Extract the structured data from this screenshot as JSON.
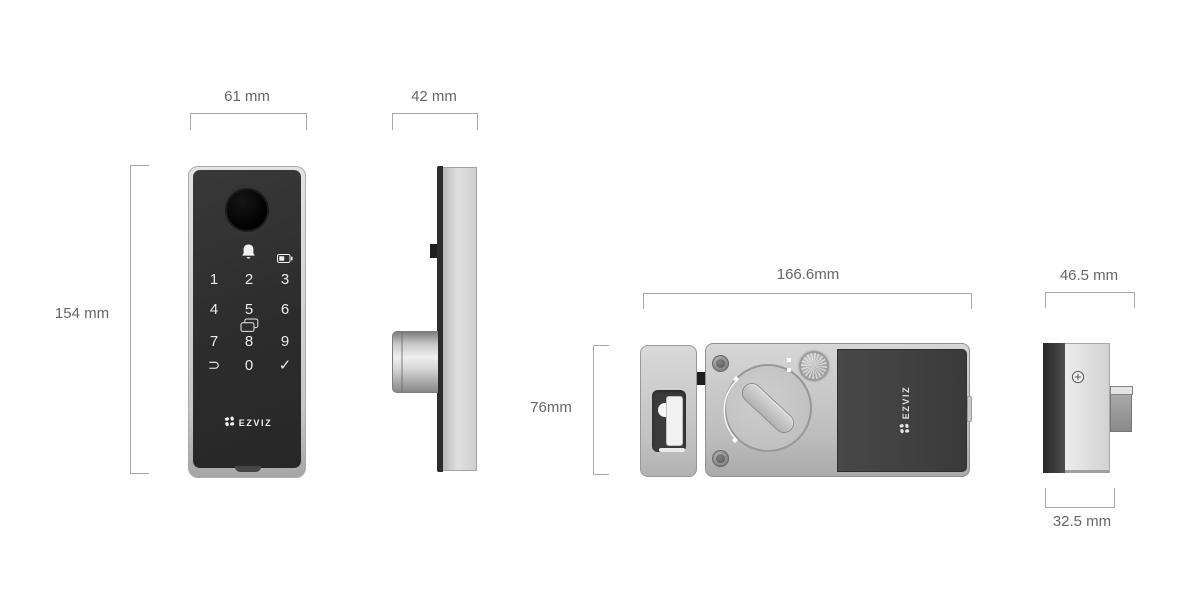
{
  "product_views": {
    "front": {
      "width_dim": "61 mm",
      "height_dim": "154 mm",
      "brand": "EZVIZ",
      "keypad_keys": [
        "1",
        "2",
        "3",
        "4",
        "5",
        "6",
        "7",
        "8",
        "9",
        "⊃",
        "0",
        "✓"
      ]
    },
    "profile": {
      "width_dim": "42 mm"
    },
    "rear": {
      "width_dim": "166.6mm",
      "height_dim": "76mm",
      "brand": "EZVIZ"
    },
    "rear_profile": {
      "width_dim": "46.5 mm",
      "depth_dim": "32.5 mm"
    }
  },
  "icons": {
    "bell": "doorbell-bell-icon",
    "battery": "battery-status-icon",
    "rfid_card": "rfid-card-icon",
    "fingerprint": "fingerprint-reader",
    "flower": "ezviz-flower-logo-icon",
    "screw_cross": "phillips-screw-icon"
  },
  "colors": {
    "background": "#ffffff",
    "dimension_text": "#666666",
    "dimension_line": "#a8a8a8",
    "panel_face": "#2e2e2e",
    "metal_light": "#cccccc",
    "battery_cover": "#3f3f3f",
    "keypad_glyphs": "#ececec"
  }
}
